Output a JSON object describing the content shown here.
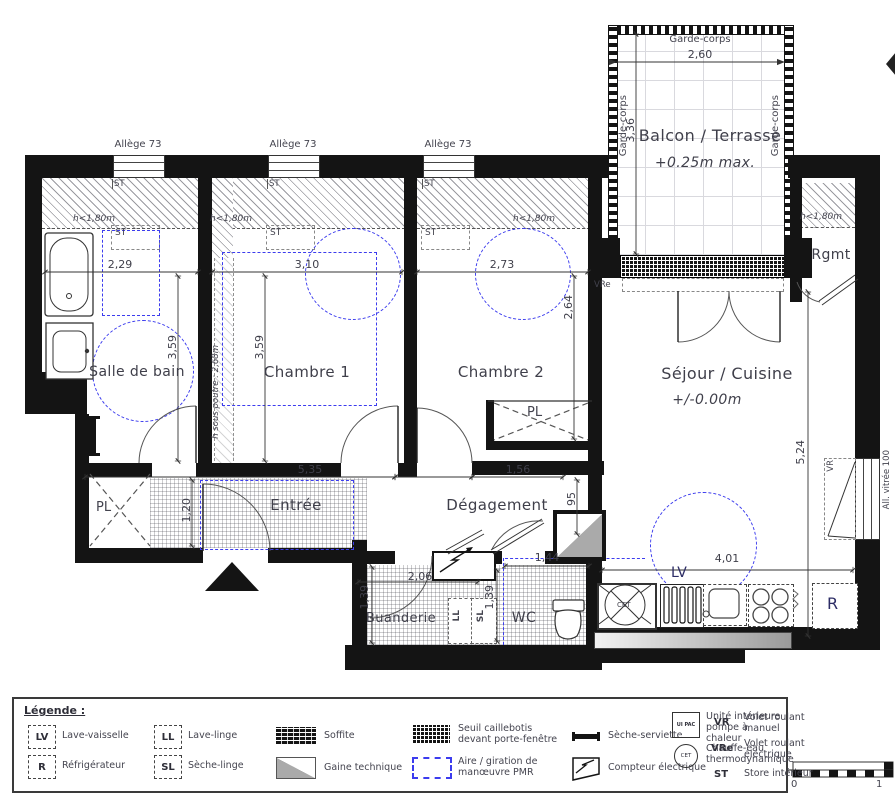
{
  "plan": {
    "rooms": {
      "salle_de_bain": "Salle de bain",
      "chambre1": "Chambre 1",
      "chambre2": "Chambre 2",
      "sejour": "Séjour / Cuisine",
      "sejour_level": "+/-0.00m",
      "entree": "Entrée",
      "degagement": "Dégagement",
      "buanderie": "Buanderie",
      "wc": "WC",
      "rgmt": "Rgmt",
      "balcon": "Balcon / Terrasse",
      "balcon_level": "+0.25m max.",
      "placard": "PL"
    },
    "annotations": {
      "allege": "Allège 73",
      "garde_corps": "Garde-corps",
      "h_180": "h<1,80m",
      "h_sous_poutre": "h sous poutre : 2,68m",
      "st": "ST",
      "vre": "VRe",
      "vr": "VR",
      "lv": "LV",
      "r": "R",
      "ll": "LL",
      "sl": "SL",
      "cet": "CET",
      "all_vitree": "All. vitrée 100"
    },
    "dims": {
      "balcon_w": "2,60",
      "balcon_h": "3,36",
      "sdb_w": "2,29",
      "sdb_h": "3,59",
      "ch1_w": "3,10",
      "ch1_h": "3,59",
      "ch2_w": "2,73",
      "ch2_h": "2,64",
      "sejour_h": "5,24",
      "sejour_w": "4,01",
      "entree_w": "5,35",
      "entree_h": "1,20",
      "degagement_w": "1,56",
      "degagement_h": "95",
      "buanderie_w": "2,06",
      "buanderie_h": "1,39",
      "wc_w": "1,44",
      "wc_h": "1,39"
    },
    "scale": {
      "zero": "0",
      "one": "1"
    }
  },
  "legend": {
    "title": "Légende :",
    "items": [
      {
        "key": "LV",
        "label": "Lave-vaisselle"
      },
      {
        "key": "R",
        "label": "Réfrigérateur"
      },
      {
        "key": "LL",
        "label": "Lave-linge"
      },
      {
        "key": "SL",
        "label": "Sèche-linge"
      },
      {
        "key": "",
        "label": "Soffite"
      },
      {
        "key": "",
        "label": "Gaine technique"
      },
      {
        "key": "",
        "label": "Seuil caillebotis devant porte-fenêtre"
      },
      {
        "key": "",
        "label": "Aire / giration de manœuvre PMR"
      },
      {
        "key": "",
        "label": "Sèche-serviette"
      },
      {
        "key": "",
        "label": "Compteur électrique"
      },
      {
        "key": "VR",
        "label": "Volet roulant manuel"
      },
      {
        "key": "VRe",
        "label": "Volet roulant électrique"
      },
      {
        "key": "ST",
        "label": "Store intérieur"
      },
      {
        "key": "UI PAC",
        "label": "Unité intérieure pompe à chaleur"
      },
      {
        "key": "CET",
        "label": "Chauffe-eau thermodynamique"
      }
    ]
  },
  "colors": {
    "wall": "#141414",
    "pmr_blue": "#3c3cee",
    "text": "#44444f"
  }
}
